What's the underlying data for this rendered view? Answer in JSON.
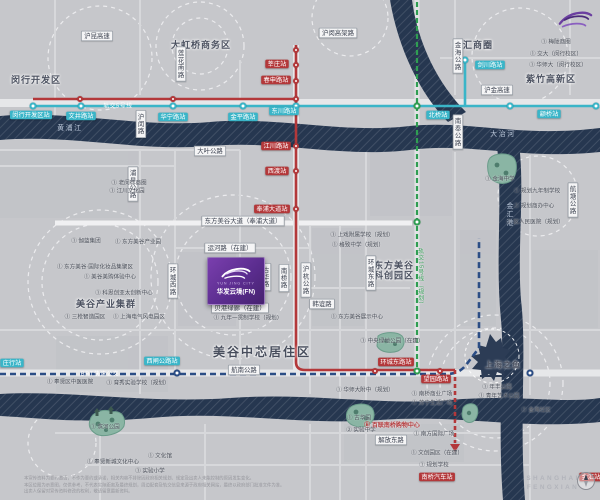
{
  "project": {
    "tagline": "YUN JING CITY",
    "name": "华发云境(FN)"
  },
  "transit_lines": [
    {
      "id": "line-5",
      "label": "轨交5号线",
      "color": "#3ab5c8",
      "style": "solid"
    },
    {
      "id": "line-5-south",
      "label": "轨交5号线南延伸",
      "color": "#b3383a",
      "style": "solid-dashed-end"
    },
    {
      "id": "line-15-planned",
      "label": "轨交15号线（规划）",
      "color": "#2f9e52",
      "style": "dashed"
    },
    {
      "id": "brt",
      "label": "BRT快速公交",
      "color": "#2b4d85",
      "style": "dashed"
    }
  ],
  "watermark": {
    "line1": "SHANGHAI",
    "line2": "FENGXIAN"
  },
  "disclaimer": {
    "line1": "本宣传资料为要约邀请，不作为要约或承诺，相关内容不排除因政府相关规划、规定及出卖人未能控制的原因发生变化。",
    "line2": "本区位图为示意图，仅供参考，不代表实际距离及最终规划，周边配套及轨交信息来源于政府相关网站，最终以政府部门批准文件为准。",
    "line3": "出卖人保留对宣传资料修改的权利，敬请留意最新资料。"
  },
  "map": {
    "labels": [
      {
        "k": "area",
        "t": "闵行开发区",
        "x": 36,
        "y": 80,
        "n": "district-minhang-kaifaqu"
      },
      {
        "k": "area",
        "t": "大虹桥商务区",
        "x": 201,
        "y": 45,
        "n": "district-dahongqiao"
      },
      {
        "k": "area",
        "t": "徐汇商圈",
        "x": 473,
        "y": 45,
        "n": "district-xuhui"
      },
      {
        "k": "area",
        "t": "紫竹高新区",
        "x": 551,
        "y": 79,
        "n": "district-zizhu"
      },
      {
        "k": "area",
        "t": "美谷产业集群",
        "x": 106,
        "y": 304,
        "n": "district-meigu-industry"
      },
      {
        "k": "area2",
        "t": "东方美谷\n科创园区",
        "x": 394,
        "y": 271,
        "n": "district-dongfang-meigu"
      },
      {
        "k": "area-lg",
        "t": "美谷中芯居住区",
        "x": 262,
        "y": 353,
        "n": "district-meigu-residential"
      },
      {
        "k": "area-s",
        "t": "上海之鱼",
        "x": 503,
        "y": 365,
        "n": "landmark-shanghai-fish-label"
      },
      {
        "k": "rivertext",
        "t": "黄浦江",
        "x": 70,
        "y": 128,
        "n": "river-label-huangpu"
      },
      {
        "k": "rivertext",
        "t": "大治河",
        "x": 503,
        "y": 134,
        "n": "river-label-dazhi"
      },
      {
        "k": "rivertextv",
        "t": "金汇港",
        "x": 510,
        "y": 215,
        "n": "river-label-jinhui"
      },
      {
        "k": "road",
        "t": "沪昆高速",
        "x": 97,
        "y": 36
      },
      {
        "k": "road",
        "t": "沪闵高架路",
        "x": 338,
        "y": 33
      },
      {
        "k": "road",
        "t": "大叶公路",
        "x": 210,
        "y": 151
      },
      {
        "k": "road",
        "t": "沪金高速",
        "x": 497,
        "y": 90
      },
      {
        "k": "road",
        "t": "东方美谷大道（奉浦大道）",
        "x": 243,
        "y": 221
      },
      {
        "k": "road",
        "t": "运河路（在建）",
        "x": 230,
        "y": 248
      },
      {
        "k": "road",
        "t": "贝港绿廊（在建）",
        "x": 240,
        "y": 308
      },
      {
        "k": "road",
        "t": "韩谊路",
        "x": 322,
        "y": 304
      },
      {
        "k": "road",
        "t": "航南公路",
        "x": 244,
        "y": 370
      },
      {
        "k": "road",
        "t": "解放东路",
        "x": 391,
        "y": 440
      },
      {
        "k": "roadv",
        "t": "莲花南路",
        "x": 181,
        "y": 64
      },
      {
        "k": "roadv",
        "t": "沪闵路",
        "x": 141,
        "y": 124
      },
      {
        "k": "roadv",
        "t": "浦星公路",
        "x": 133,
        "y": 184
      },
      {
        "k": "roadv",
        "t": "环城西路",
        "x": 173,
        "y": 281
      },
      {
        "k": "roadv",
        "t": "古华路",
        "x": 266,
        "y": 277
      },
      {
        "k": "roadv",
        "t": "南桥路",
        "x": 284,
        "y": 278
      },
      {
        "k": "roadv",
        "t": "沪杭公路",
        "x": 306,
        "y": 280
      },
      {
        "k": "roadv",
        "t": "环城东路",
        "x": 371,
        "y": 273
      },
      {
        "k": "roadv",
        "t": "金海公路",
        "x": 458,
        "y": 56
      },
      {
        "k": "roadv",
        "t": "南奉公路",
        "x": 458,
        "y": 132
      },
      {
        "k": "roadv",
        "t": "航塘公路",
        "x": 573,
        "y": 200
      },
      {
        "k": "cyan",
        "t": "闵行开发区站",
        "x": 31,
        "y": 115
      },
      {
        "k": "cyan",
        "t": "文井路站",
        "x": 81,
        "y": 116
      },
      {
        "k": "cyan",
        "t": "华宁路站",
        "x": 173,
        "y": 117
      },
      {
        "k": "cyan",
        "t": "金平路站",
        "x": 243,
        "y": 117
      },
      {
        "k": "cyan",
        "t": "东川路站",
        "x": 284,
        "y": 111
      },
      {
        "k": "cyan",
        "t": "北桥站",
        "x": 438,
        "y": 115
      },
      {
        "k": "cyan",
        "t": "剑川路站",
        "x": 490,
        "y": 65
      },
      {
        "k": "cyan",
        "t": "颛桥站",
        "x": 549,
        "y": 114
      },
      {
        "k": "cyan",
        "t": "西闸公路站",
        "x": 162,
        "y": 361
      },
      {
        "k": "cyan",
        "t": "庄行站",
        "x": 12,
        "y": 363
      },
      {
        "k": "red",
        "t": "莘庄站",
        "x": 277,
        "y": 64
      },
      {
        "k": "red",
        "t": "春申路站",
        "x": 276,
        "y": 80
      },
      {
        "k": "red",
        "t": "江川路站",
        "x": 276,
        "y": 146
      },
      {
        "k": "red",
        "t": "西渡站",
        "x": 277,
        "y": 171
      },
      {
        "k": "red",
        "t": "奉浦大道站",
        "x": 272,
        "y": 209
      },
      {
        "k": "red",
        "t": "环城东路站",
        "x": 396,
        "y": 362
      },
      {
        "k": "red",
        "t": "望园路站",
        "x": 436,
        "y": 379
      },
      {
        "k": "red",
        "t": "南桥汽车站",
        "x": 437,
        "y": 477
      },
      {
        "k": "red",
        "t": "金汇站",
        "x": 591,
        "y": 477
      },
      {
        "k": "linecyan",
        "t": "轨交5号线",
        "x": 118,
        "y": 106
      },
      {
        "k": "lineblue",
        "t": "BRT快速公交",
        "x": 100,
        "y": 374
      },
      {
        "k": "linegreen",
        "t": "轨交15号线（规划）",
        "x": 421,
        "y": 278
      },
      {
        "k": "poi",
        "t": "① 老闵行商圈",
        "x": 129,
        "y": 183
      },
      {
        "k": "poi",
        "t": "① 江川文化园",
        "x": 127,
        "y": 191
      },
      {
        "k": "poi",
        "t": "① 伽蓝集团",
        "x": 86,
        "y": 241
      },
      {
        "k": "poi",
        "t": "① 东方美谷产业园",
        "x": 138,
        "y": 242
      },
      {
        "k": "poi",
        "t": "① 东方美谷·国际化妆品集聚区",
        "x": 95,
        "y": 267
      },
      {
        "k": "poi",
        "t": "① 美谷美购体验中心",
        "x": 110,
        "y": 277
      },
      {
        "k": "poi",
        "t": "① 科思创亚太创新中心",
        "x": 124,
        "y": 293
      },
      {
        "k": "poi",
        "t": "① 三枪智造园区",
        "x": 85,
        "y": 317
      },
      {
        "k": "poi",
        "t": "① 上海电气风电园区",
        "x": 139,
        "y": 317
      },
      {
        "k": "poi",
        "t": "① 上戏附属学校（规划）",
        "x": 362,
        "y": 235
      },
      {
        "k": "poi",
        "t": "① 格致中学（规划）",
        "x": 358,
        "y": 245
      },
      {
        "k": "poi",
        "t": "① 九年一贯制学校（规划）",
        "x": 248,
        "y": 318
      },
      {
        "k": "poi",
        "t": "① 东方美谷展示中心",
        "x": 357,
        "y": 317
      },
      {
        "k": "poi",
        "t": "① 奉贤区中医医院",
        "x": 70,
        "y": 382
      },
      {
        "k": "poi",
        "t": "① 育秀实验学校（规划）",
        "x": 138,
        "y": 383
      },
      {
        "k": "poi",
        "t": "① 滨河公园",
        "x": 105,
        "y": 427
      },
      {
        "k": "poi",
        "t": "① 奉贤新城文化中心",
        "x": 113,
        "y": 462
      },
      {
        "k": "poi",
        "t": "① 文化馆",
        "x": 160,
        "y": 456
      },
      {
        "k": "poi",
        "t": "① 实验小学",
        "x": 150,
        "y": 471
      },
      {
        "k": "poi",
        "t": "① 中央绿地公园（在建）",
        "x": 392,
        "y": 341
      },
      {
        "k": "poi",
        "t": "① 华师大附中（规划）",
        "x": 365,
        "y": 390
      },
      {
        "k": "poi",
        "t": "① 古华园",
        "x": 359,
        "y": 418
      },
      {
        "k": "poi",
        "t": "② 实验中学",
        "x": 361,
        "y": 430
      },
      {
        "k": "poi",
        "t": "① 南桥商业广场",
        "x": 432,
        "y": 394
      },
      {
        "k": "poi",
        "t": "① 苏宁生活广场",
        "x": 432,
        "y": 403
      },
      {
        "k": "poi",
        "t": "① 南方国际广场",
        "x": 434,
        "y": 434
      },
      {
        "k": "poi",
        "t": "① 文创园区（在建）",
        "x": 437,
        "y": 453
      },
      {
        "k": "poi",
        "t": "① 规划学校",
        "x": 434,
        "y": 465
      },
      {
        "k": "poi",
        "t": "① 梅陇商圈",
        "x": 556,
        "y": 42
      },
      {
        "k": "poi",
        "t": "① 交大（闵行校区）",
        "x": 556,
        "y": 54
      },
      {
        "k": "poi",
        "t": "① 华师大（闵行校区）",
        "x": 558,
        "y": 65
      },
      {
        "k": "poi",
        "t": "① 金海中学",
        "x": 500,
        "y": 179
      },
      {
        "k": "poi",
        "t": "① 规划九年制学校",
        "x": 537,
        "y": 191
      },
      {
        "k": "poi",
        "t": "① 规划商办中心",
        "x": 534,
        "y": 206
      },
      {
        "k": "poi",
        "t": "① 区人民医院（规划）",
        "x": 535,
        "y": 222
      },
      {
        "k": "poi",
        "t": "① 年丰公园",
        "x": 497,
        "y": 387
      },
      {
        "k": "poi",
        "t": "① 青年艺术公园",
        "x": 499,
        "y": 396
      },
      {
        "k": "poi",
        "t": "① 金海社区",
        "x": 536,
        "y": 410
      },
      {
        "k": "poired",
        "t": "Ⓑ 百联南桥购物中心",
        "x": 392,
        "y": 425,
        "n": "poi-bailian-mall"
      },
      {
        "k": "wm",
        "t": "SHANGHAI",
        "x": 553,
        "y": 478,
        "n": "watermark-line1"
      },
      {
        "k": "wm",
        "t": "FENGXIAN",
        "x": 553,
        "y": 487,
        "n": "watermark-line2"
      }
    ],
    "stations": [
      {
        "x": 33,
        "y": 106,
        "c": "cyan"
      },
      {
        "x": 81,
        "y": 106,
        "c": "cyan"
      },
      {
        "x": 173,
        "y": 106,
        "c": "cyan"
      },
      {
        "x": 243,
        "y": 106,
        "c": "cyan"
      },
      {
        "x": 296,
        "y": 106,
        "c": "cyan"
      },
      {
        "x": 510,
        "y": 106,
        "c": "cyan"
      },
      {
        "x": 596,
        "y": 106,
        "c": "cyan"
      },
      {
        "x": 465,
        "y": 60,
        "c": "cyan"
      },
      {
        "x": 80,
        "y": 99,
        "c": "red"
      },
      {
        "x": 173,
        "y": 99,
        "c": "red"
      },
      {
        "x": 296,
        "y": 99,
        "c": "red"
      },
      {
        "x": 296,
        "y": 50,
        "c": "red"
      },
      {
        "x": 296,
        "y": 65,
        "c": "red"
      },
      {
        "x": 296,
        "y": 81,
        "c": "red"
      },
      {
        "x": 296,
        "y": 146,
        "c": "red"
      },
      {
        "x": 296,
        "y": 171,
        "c": "red"
      },
      {
        "x": 296,
        "y": 209,
        "c": "red"
      },
      {
        "x": 375,
        "y": 371,
        "c": "red"
      },
      {
        "x": 440,
        "y": 371,
        "c": "red"
      },
      {
        "x": 417,
        "y": 106,
        "c": "green"
      },
      {
        "x": 417,
        "y": 222,
        "c": "green"
      },
      {
        "x": 417,
        "y": 371,
        "c": "green"
      },
      {
        "x": 177,
        "y": 373,
        "c": "blue"
      },
      {
        "x": 530,
        "y": 373,
        "c": "blue"
      }
    ]
  }
}
